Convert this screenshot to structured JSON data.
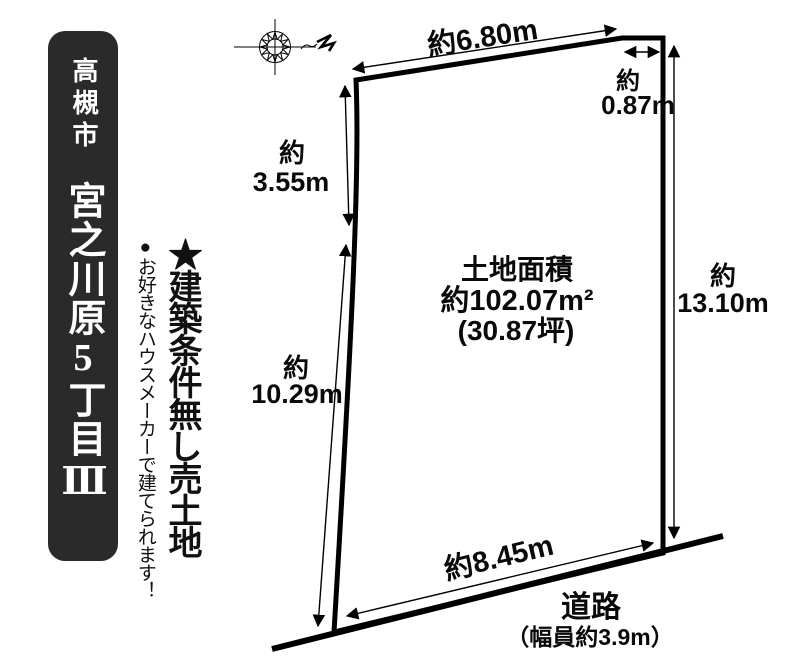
{
  "banner": {
    "city": "高槻市",
    "name": "宮之川原5丁目Ⅲ",
    "bg_color": "#2a2a2a",
    "text_color": "#ffffff"
  },
  "tagline": {
    "main": "★建築条件無し売土地",
    "sub": "●お好きなハウスメーカーで建てられます！"
  },
  "diagram": {
    "ink_color": "#000000",
    "compass": "compass-rose",
    "dims": {
      "top": "約6.80m",
      "top_right_prefix": "約",
      "top_right": "0.87m",
      "right_prefix": "約",
      "right": "13.10m",
      "left_upper_prefix": "約",
      "left_upper": "3.55m",
      "left_lower_prefix": "約",
      "left_lower": "10.29m",
      "bottom": "約8.45m"
    },
    "area": {
      "title": "土地面積",
      "value": "約102.07m²",
      "tsubo": "(30.87坪)"
    },
    "road": {
      "label": "道路",
      "width": "（幅員約3.9m）"
    }
  }
}
